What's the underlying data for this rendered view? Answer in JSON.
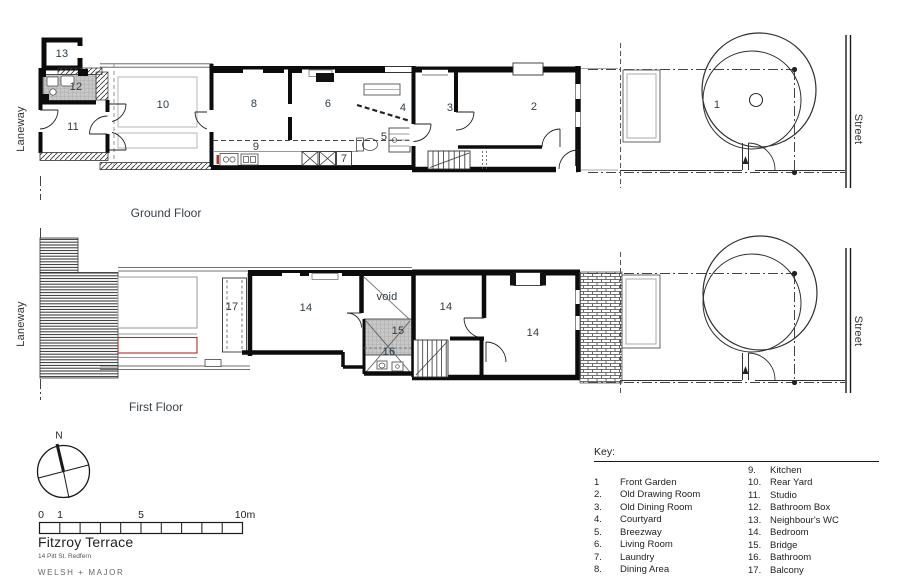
{
  "ground_floor": {
    "caption": "Ground Floor",
    "laneway": "Laneway",
    "street": "Street",
    "rooms": [
      {
        "label": "13"
      },
      {
        "label": "12"
      },
      {
        "label": "11"
      },
      {
        "label": "10"
      },
      {
        "label": "8"
      },
      {
        "label": "6"
      },
      {
        "label": "9"
      },
      {
        "label": "7"
      },
      {
        "label": "5"
      },
      {
        "label": "4"
      },
      {
        "label": "3"
      },
      {
        "label": "2"
      },
      {
        "label": "1"
      }
    ]
  },
  "first_floor": {
    "caption": "First Floor",
    "laneway": "Laneway",
    "street": "Street",
    "rooms": [
      {
        "label": "17"
      },
      {
        "label": "14"
      },
      {
        "label": "void"
      },
      {
        "label": "15"
      },
      {
        "label": "16"
      },
      {
        "label": "14"
      },
      {
        "label": "14"
      }
    ]
  },
  "key": {
    "title": "Key:",
    "col1": [
      {
        "num": "1",
        "label": "Front Garden"
      },
      {
        "num": "2.",
        "label": "Old Drawing Room"
      },
      {
        "num": "3.",
        "label": "Old Dining Room"
      },
      {
        "num": "4.",
        "label": "Courtyard"
      },
      {
        "num": "5.",
        "label": "Breezway"
      },
      {
        "num": "6.",
        "label": "Living Room"
      },
      {
        "num": "7.",
        "label": "Laundry"
      },
      {
        "num": "8.",
        "label": "Dining Area"
      }
    ],
    "col2": [
      {
        "num": "9.",
        "label": "Kitchen"
      },
      {
        "num": "10.",
        "label": "Rear Yard"
      },
      {
        "num": "11.",
        "label": "Studio"
      },
      {
        "num": "12.",
        "label": "Bathroom Box"
      },
      {
        "num": "13.",
        "label": "Neighbour's WC"
      },
      {
        "num": "14.",
        "label": "Bedroom"
      },
      {
        "num": "15.",
        "label": "Bridge"
      },
      {
        "num": "16.",
        "label": "Bathroom"
      },
      {
        "num": "17.",
        "label": "Balcony"
      }
    ]
  },
  "scale_bar": {
    "labels": [
      "0",
      "1",
      "5",
      "10m"
    ]
  },
  "compass": {
    "north": "N"
  },
  "title_block": {
    "title": "Fitzroy Terrace",
    "address": "14 Pitt St. Redfern",
    "firm": "WELSH + MAJOR"
  },
  "colors": {
    "wall": "#111111",
    "accent_red": "#b03026",
    "gray_fill": "#c7c7c7"
  }
}
